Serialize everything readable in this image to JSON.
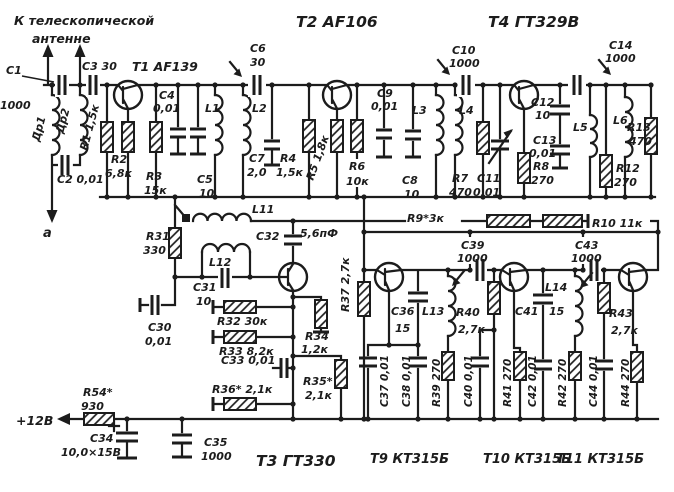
{
  "colors": {
    "ink": "#1c1c1c",
    "paper": "#ffffff"
  },
  "annotations": {
    "antenna_line1": "К телескопической",
    "antenna_line2": "антенне",
    "terminal_a": "а",
    "power": "+12В"
  },
  "transistors": {
    "t1": "Т1 AF139",
    "t2": "Т2 AF106",
    "t3": "Т3 ГТ330",
    "t4": "Т4 ГТ329В",
    "t9": "Т9 КТ315Б",
    "t10": "Т10 КТ315Б",
    "t11": "Т11 КТ315Б"
  },
  "inductors": {
    "dr1": "Др1",
    "dr2": "Др2",
    "l1": "L1",
    "l2": "L2",
    "l3": "L3",
    "l4": "L4",
    "l5": "L5",
    "l6": "L6",
    "l11": "L11",
    "l12": "L12",
    "l13": "L13",
    "l14": "L14"
  },
  "parts": {
    "c1_ref": "С1",
    "c1_val": "1000",
    "c2": "С2 0,01",
    "c3": "С3 30",
    "c4_ref": "С4",
    "c4_val": "0,01",
    "c5_ref": "С5",
    "c5_val": "10",
    "c6_ref": "С6",
    "c6_val": "30",
    "c7_ref": "С7",
    "c7_val": "2,0",
    "c8_ref": "С8",
    "c8_val": "10",
    "c9_ref": "С9",
    "c9_val": "0,01",
    "c10_ref": "С10",
    "c10_val": "1000",
    "c11_ref": "С11",
    "c11_val": "0,01",
    "c12_ref": "С12",
    "c12_val": "10",
    "c13_ref": "С13",
    "c13_val": "0,01",
    "c14_ref": "С14",
    "c14_val": "1000",
    "c30_ref": "С30",
    "c30_val": "0,01",
    "c31_ref": "С31",
    "c31_val": "10",
    "c32_ref": "С32",
    "c32_val": "5,6пФ",
    "c33": "С33 0,01",
    "c34_ref": "С34",
    "c34_val": "10,0×15В",
    "c35_ref": "С35",
    "c35_val": "1000",
    "c36_ref": "С36",
    "c36_val": "15",
    "c37": "С37 0,01",
    "c38": "С38 0,01",
    "c39_ref": "С39",
    "c39_val": "1000",
    "c40": "С40 0,01",
    "c41_ref": "С41",
    "c41_val": "15",
    "c42": "С42 0,01",
    "c43_ref": "С43",
    "c43_val": "1000",
    "c44": "С44 0,01",
    "r1": "R1 1,5к",
    "r2_ref": "R2",
    "r2_val": "6,8к",
    "r3_ref": "R3",
    "r3_val": "15к",
    "r4_ref": "R4",
    "r4_val": "1,5к",
    "r5": "R5 1,8к",
    "r6_ref": "R6",
    "r6_val": "10к",
    "r7_ref": "R7",
    "r7_val": "470",
    "r8_ref": "R8",
    "r8_val": "270",
    "r9": "R9*3к",
    "r10": "R10 11к",
    "r12_ref": "R12",
    "r12_val": "270",
    "r13_ref": "R13",
    "r13_val": "470",
    "r31_ref": "R31",
    "r31_val": "330",
    "r32": "R32 30к",
    "r33": "R33 8,2к",
    "r34_ref": "R34",
    "r34_val": "1,2к",
    "r35_ref": "R35*",
    "r35_val": "2,1к",
    "r36": "R36* 2,1к",
    "r37": "R37 2,7к",
    "r39": "R39 270",
    "r40_ref": "R40",
    "r40_val": "2,7к",
    "r41": "R41 270",
    "r42": "R42 270",
    "r43_ref": "R43",
    "r43_val": "2,7к",
    "r44": "R44 270",
    "r54_ref": "R54*",
    "r54_val": "930"
  }
}
